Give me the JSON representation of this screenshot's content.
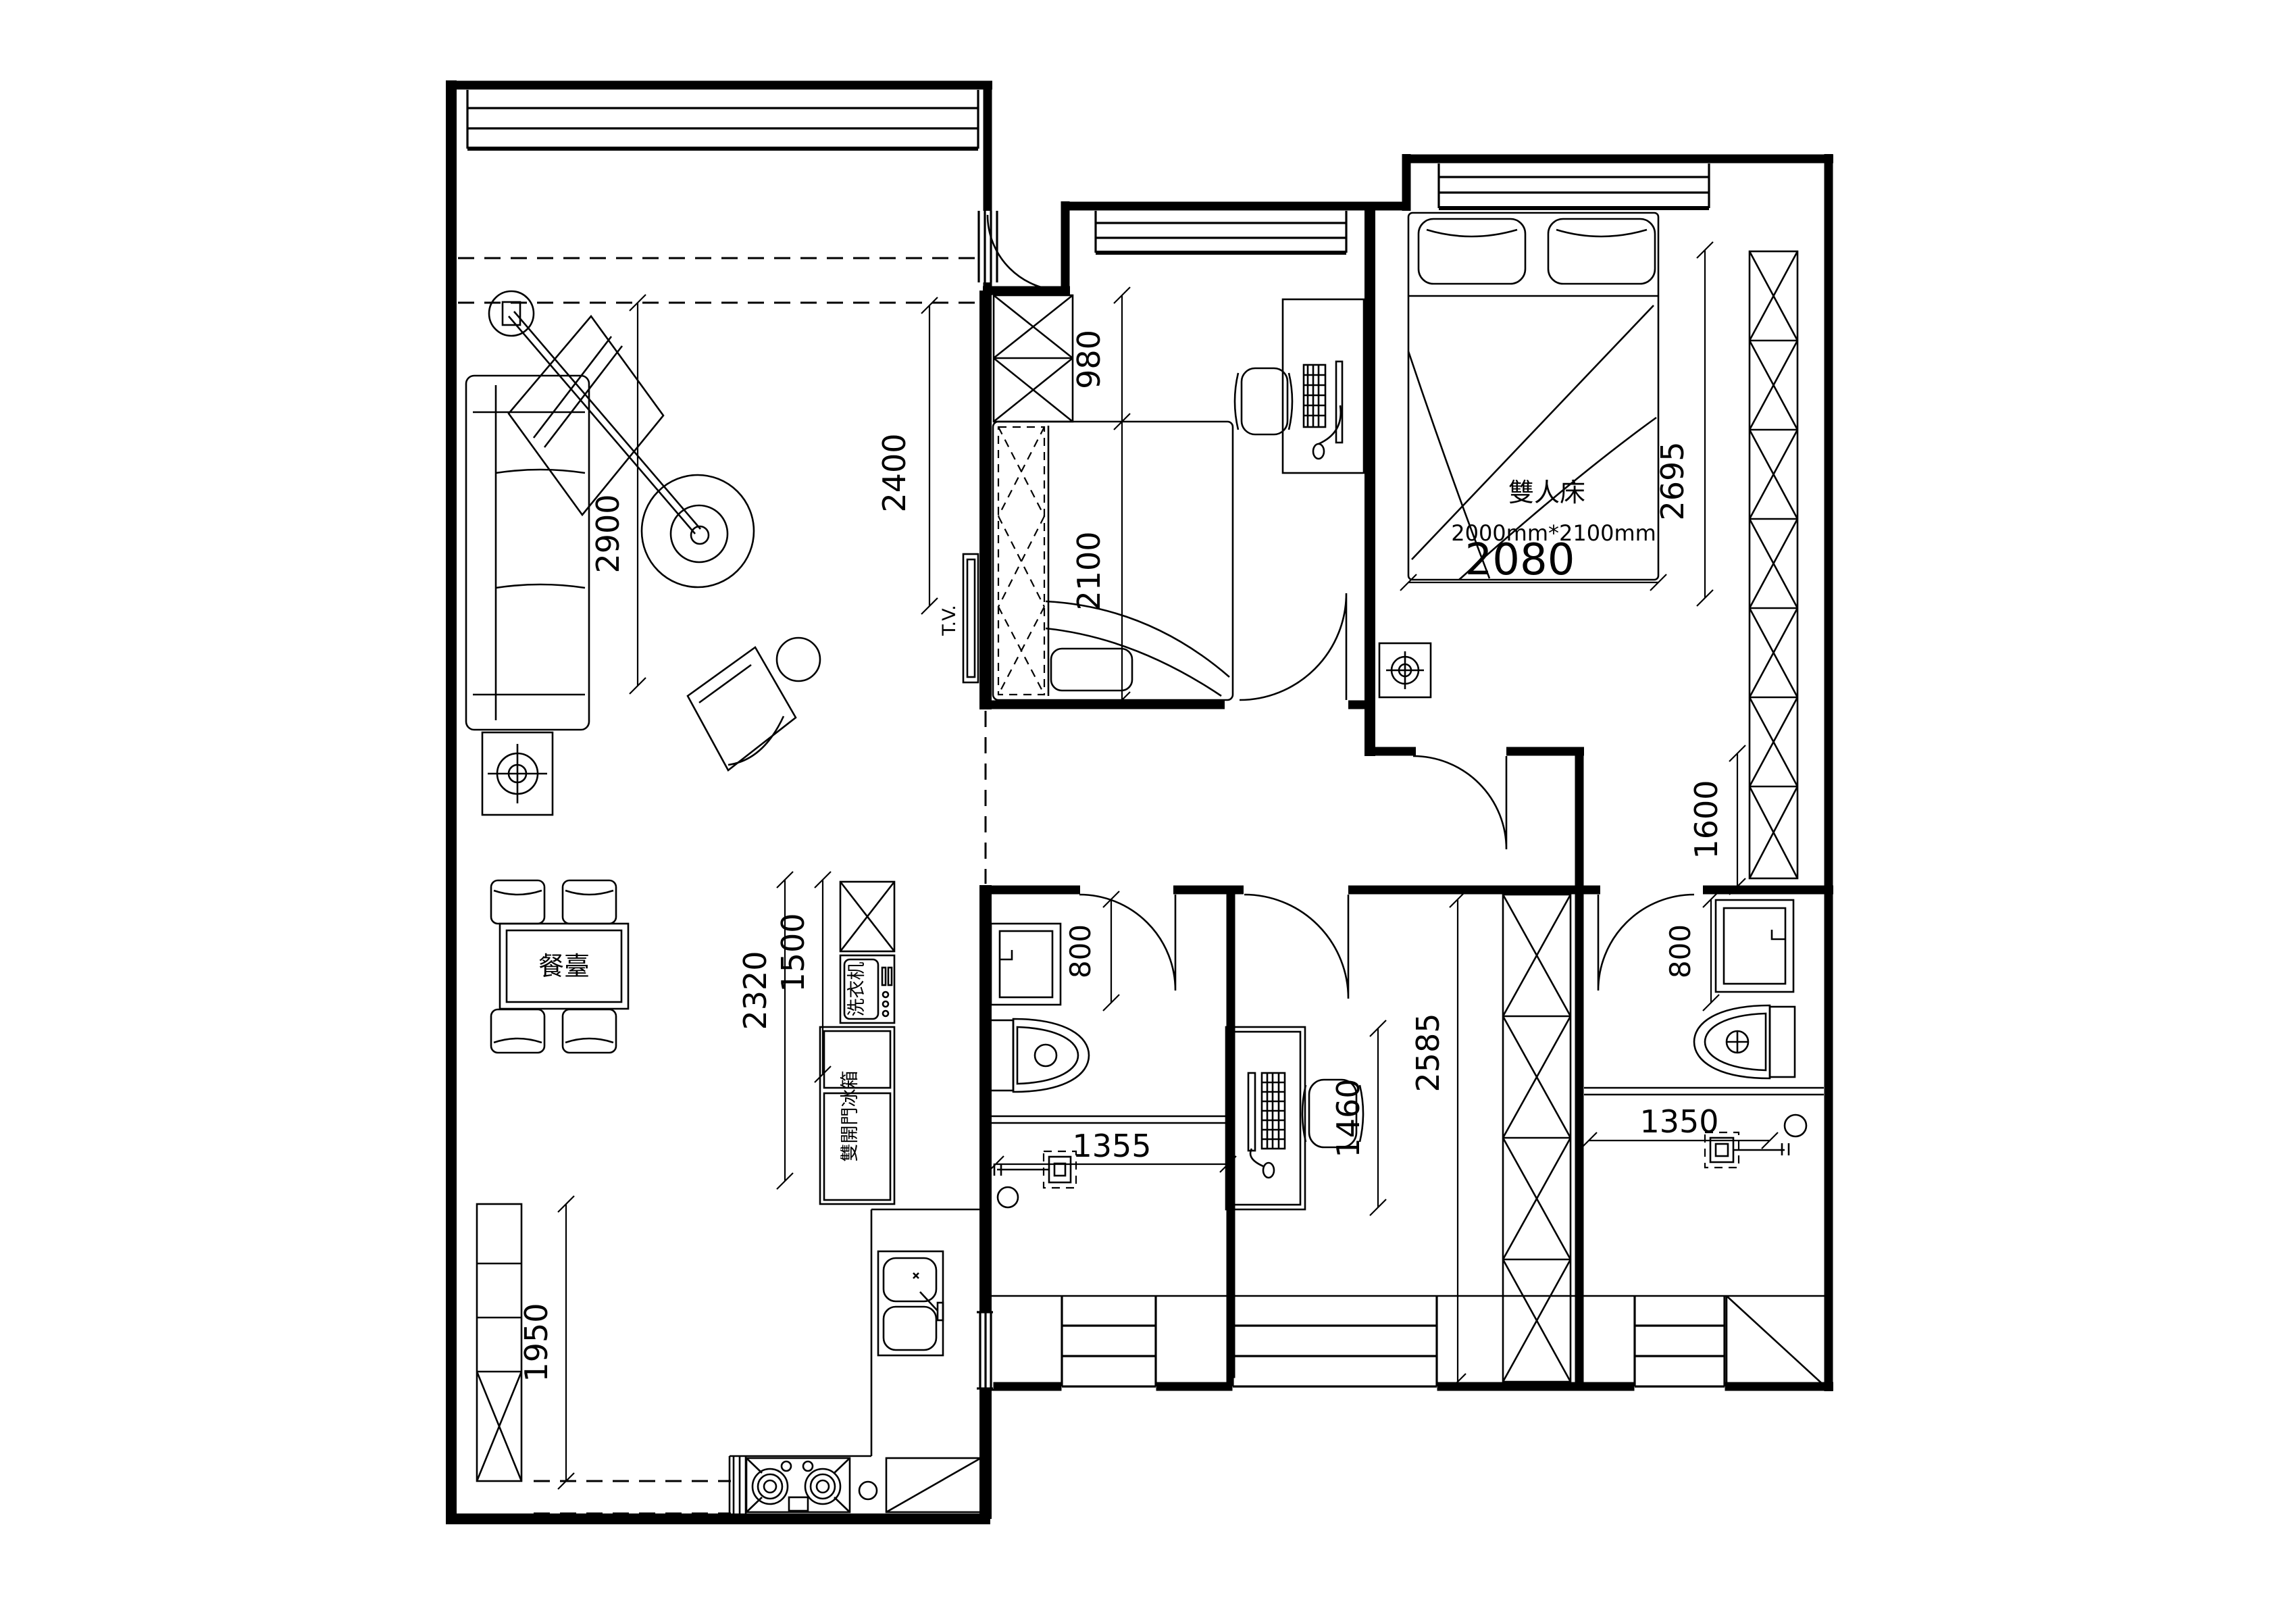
{
  "drawing": {
    "type": "apartment-floor-plan",
    "labels": {
      "master_bed": "雙人床",
      "master_bed_size": "2000mm*2100mm",
      "dining_table": "餐臺",
      "washing_machine": "洗衣机",
      "fridge": "雙開門冰箱",
      "tv": "T.V."
    },
    "dimensions": {
      "living_depth": "2900",
      "tv_wall": "2400",
      "wardrobe2": "980",
      "bed2_length": "2100",
      "master_bed_width": "2080",
      "master_depth": "2695",
      "master_lower": "1600",
      "bath1_door": "800",
      "bath2_door": "800",
      "appliance_upper": "1500",
      "appliance_total": "2320",
      "bath1_width": "1355",
      "bath2_width": "1350",
      "study_desk_span": "1460",
      "study_depth": "2585",
      "foyer_cabinet": "1950"
    }
  }
}
